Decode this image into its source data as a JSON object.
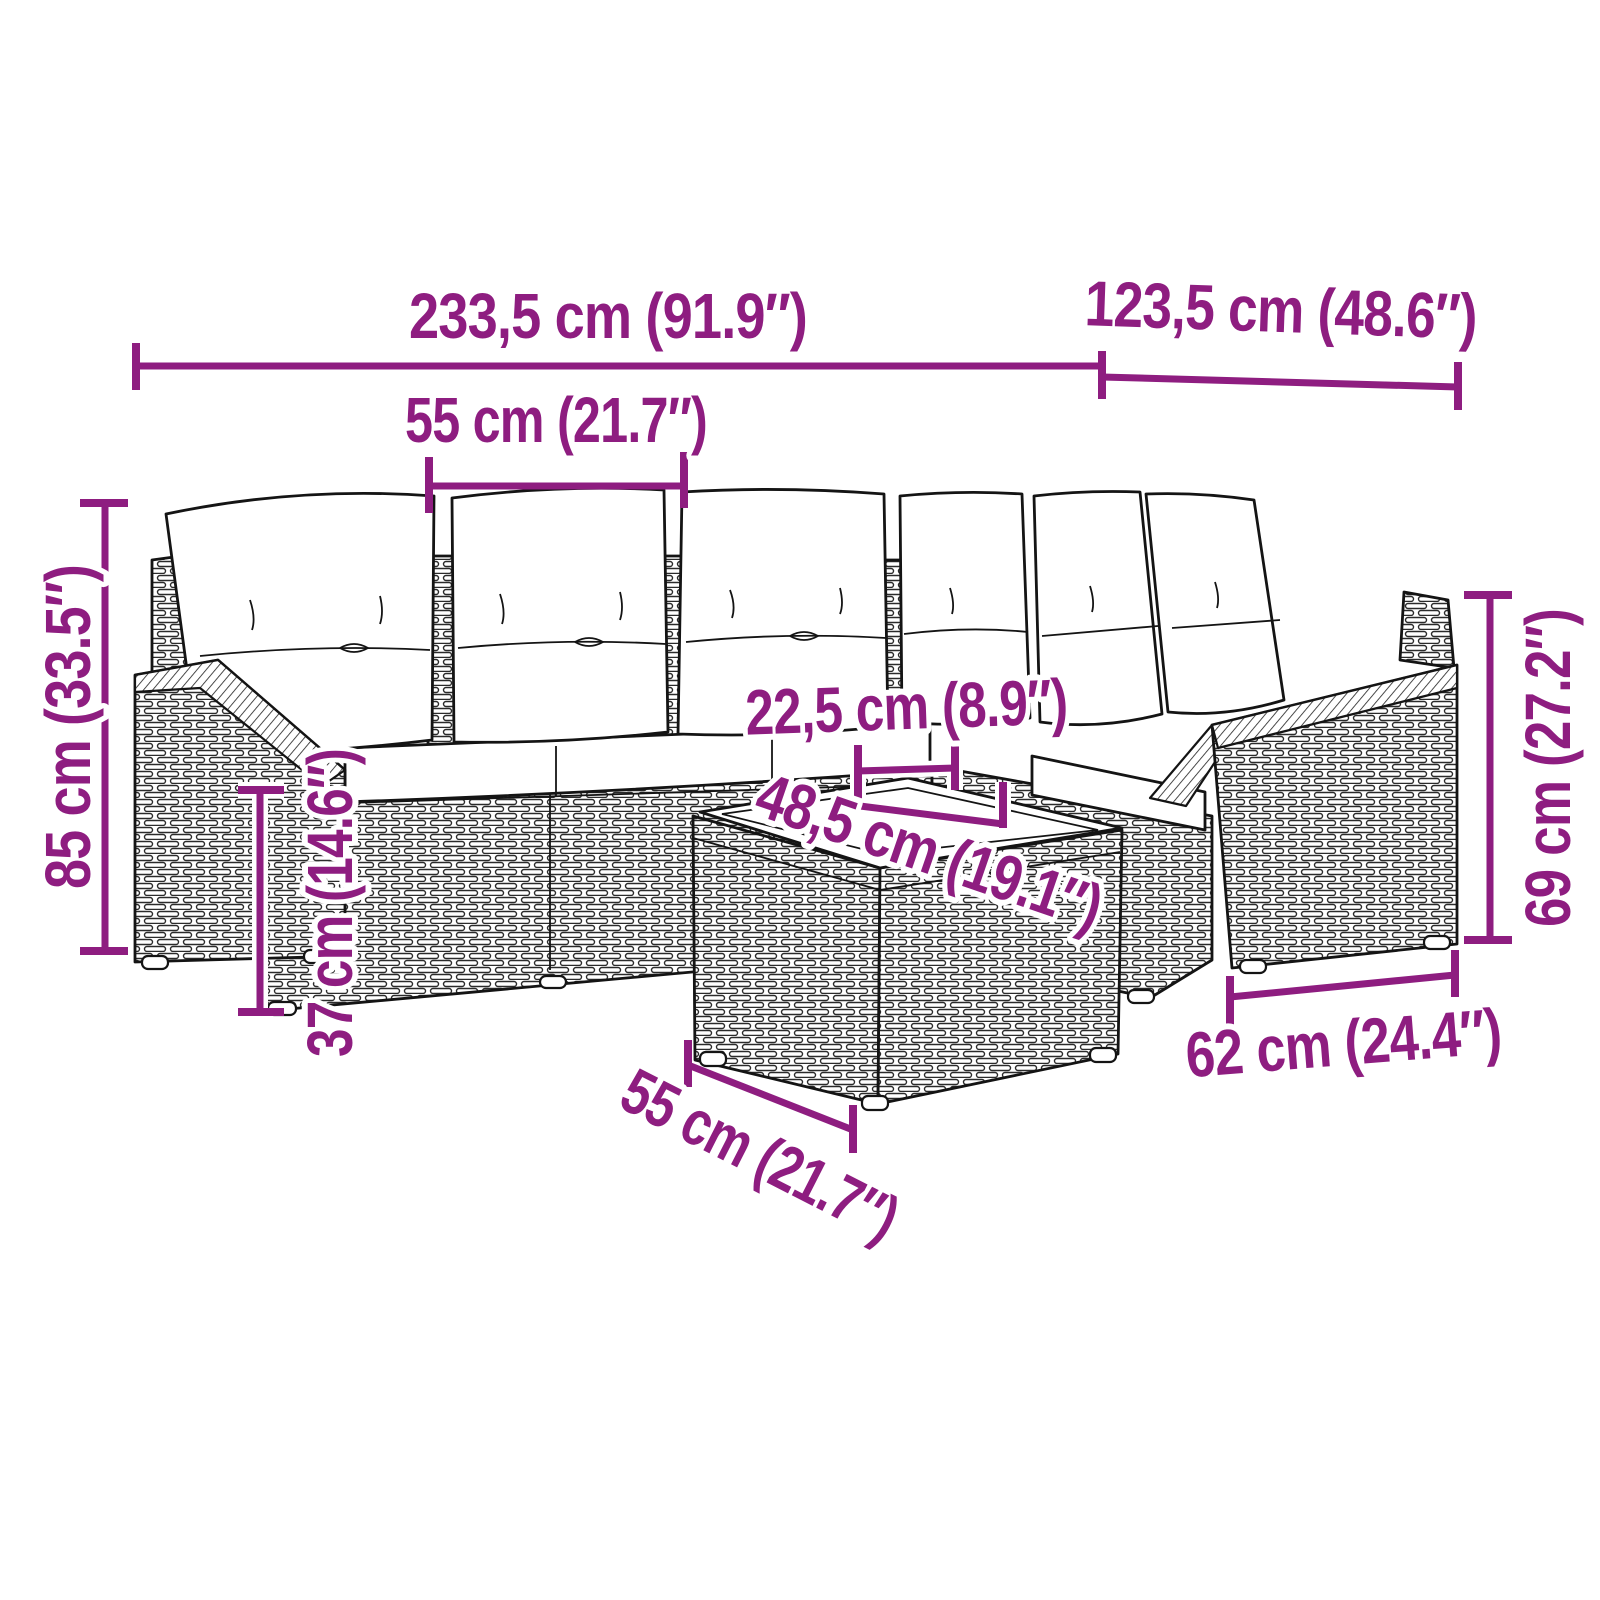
{
  "diagram_type": "furniture-dimension-diagram",
  "subject": "rattan corner garden sofa set with cushions and coffee table (line drawing)",
  "accent_color": "#8E1D80",
  "outline_color": "#141414",
  "background_color": "#FFFFFF",
  "dims": {
    "sofa_total_width": "233,5 cm (91.9″)",
    "sofa_total_depth": "123,5 cm (48.6″)",
    "seat_module_width": "55 cm (21.7″)",
    "sofa_total_height": "85 cm (33.5″)",
    "seat_height": "37 cm (14.6″)",
    "table_gap": "22,5 cm (8.9″)",
    "table_top_width": "48,5 cm (19.1″)",
    "armrest_height": "69 cm (27.2″)",
    "armrest_module_depth": "62 cm (24.4″)",
    "table_top_depth": "55 cm (21.7″)"
  }
}
